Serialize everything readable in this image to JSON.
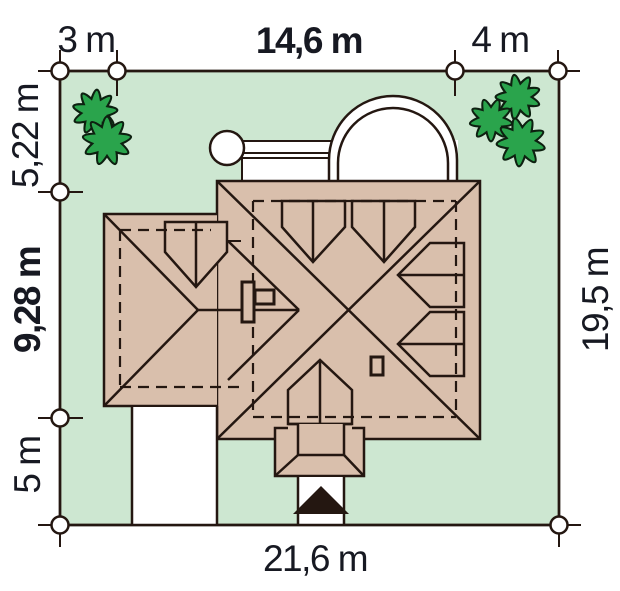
{
  "scene": {
    "type": "architectural-site-plan",
    "description": "Roof-plan of a house on a plot with boundary survey markers, two trees, driveway and entrance walkway"
  },
  "dim_labels": {
    "top_left": "3 m",
    "top_center": "14,6 m",
    "top_right": "4 m",
    "left_top": "5,22 m",
    "left_middle": "9,28 m",
    "left_bottom": "5 m",
    "right_side": "19,5 m",
    "bottom": "21,6 m"
  },
  "colors": {
    "plot": "#cde7d1",
    "roof": "#d9bfac",
    "tree": "#2aa44c",
    "line": "#241711",
    "text": "#171922",
    "paving": "#ffffff"
  },
  "counts": {
    "survey_markers": 8,
    "trees": 2,
    "roof_dormers": 6
  }
}
